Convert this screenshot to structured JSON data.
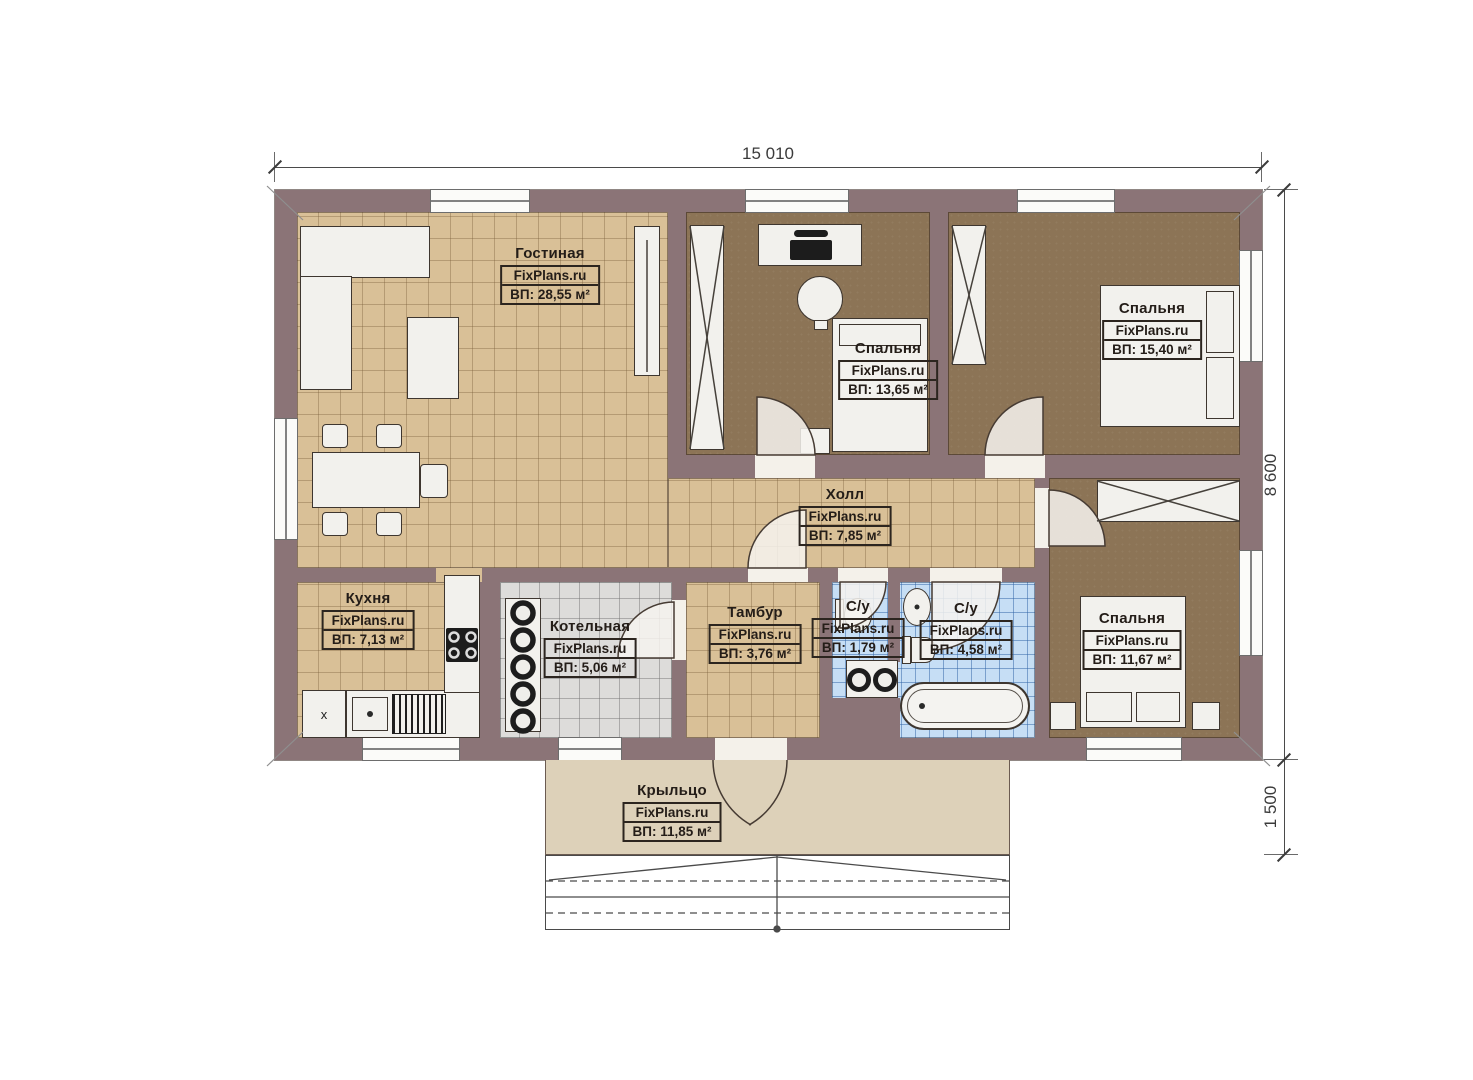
{
  "dimensions": {
    "top": "15 010",
    "right_main": "8 600",
    "right_porch": "1 500"
  },
  "rooms": [
    {
      "id": "living",
      "name": "Гостиная",
      "brand": "FixPlans.ru",
      "area": "ВП: 28,55 м²"
    },
    {
      "id": "bedroom1",
      "name": "Спальня",
      "brand": "FixPlans.ru",
      "area": "ВП: 13,65 м²"
    },
    {
      "id": "bedroom2",
      "name": "Спальня",
      "brand": "FixPlans.ru",
      "area": "ВП: 15,40 м²"
    },
    {
      "id": "hall",
      "name": "Холл",
      "brand": "FixPlans.ru",
      "area": "ВП: 7,85 м²"
    },
    {
      "id": "kitchen",
      "name": "Кухня",
      "brand": "FixPlans.ru",
      "area": "ВП: 7,13 м²"
    },
    {
      "id": "boiler",
      "name": "Котельная",
      "brand": "FixPlans.ru",
      "area": "ВП: 5,06 м²"
    },
    {
      "id": "tambour",
      "name": "Тамбур",
      "brand": "FixPlans.ru",
      "area": "ВП: 3,76 м²"
    },
    {
      "id": "wc_small",
      "name": "С/у",
      "brand": "FixPlans.ru",
      "area": "ВП: 1,79 м²"
    },
    {
      "id": "wc_big",
      "name": "С/у",
      "brand": "FixPlans.ru",
      "area": "ВП: 4,58 м²"
    },
    {
      "id": "bedroom3",
      "name": "Спальня",
      "brand": "FixPlans.ru",
      "area": "ВП: 11,67 м²"
    },
    {
      "id": "porch",
      "name": "Крыльцо",
      "brand": "FixPlans.ru",
      "area": "ВП: 11,85 м²"
    }
  ],
  "marks": {
    "fridge": "x"
  },
  "colors": {
    "wall": "#8b7477",
    "floor_tile_tan": "#d9c097",
    "floor_bedroom": "#8c7456",
    "floor_bathroom": "#c6def5",
    "floor_boiler": "#dddcda",
    "porch": "#ddd1b9",
    "furniture": "#f2f1ed",
    "linework": "#3e362f"
  }
}
